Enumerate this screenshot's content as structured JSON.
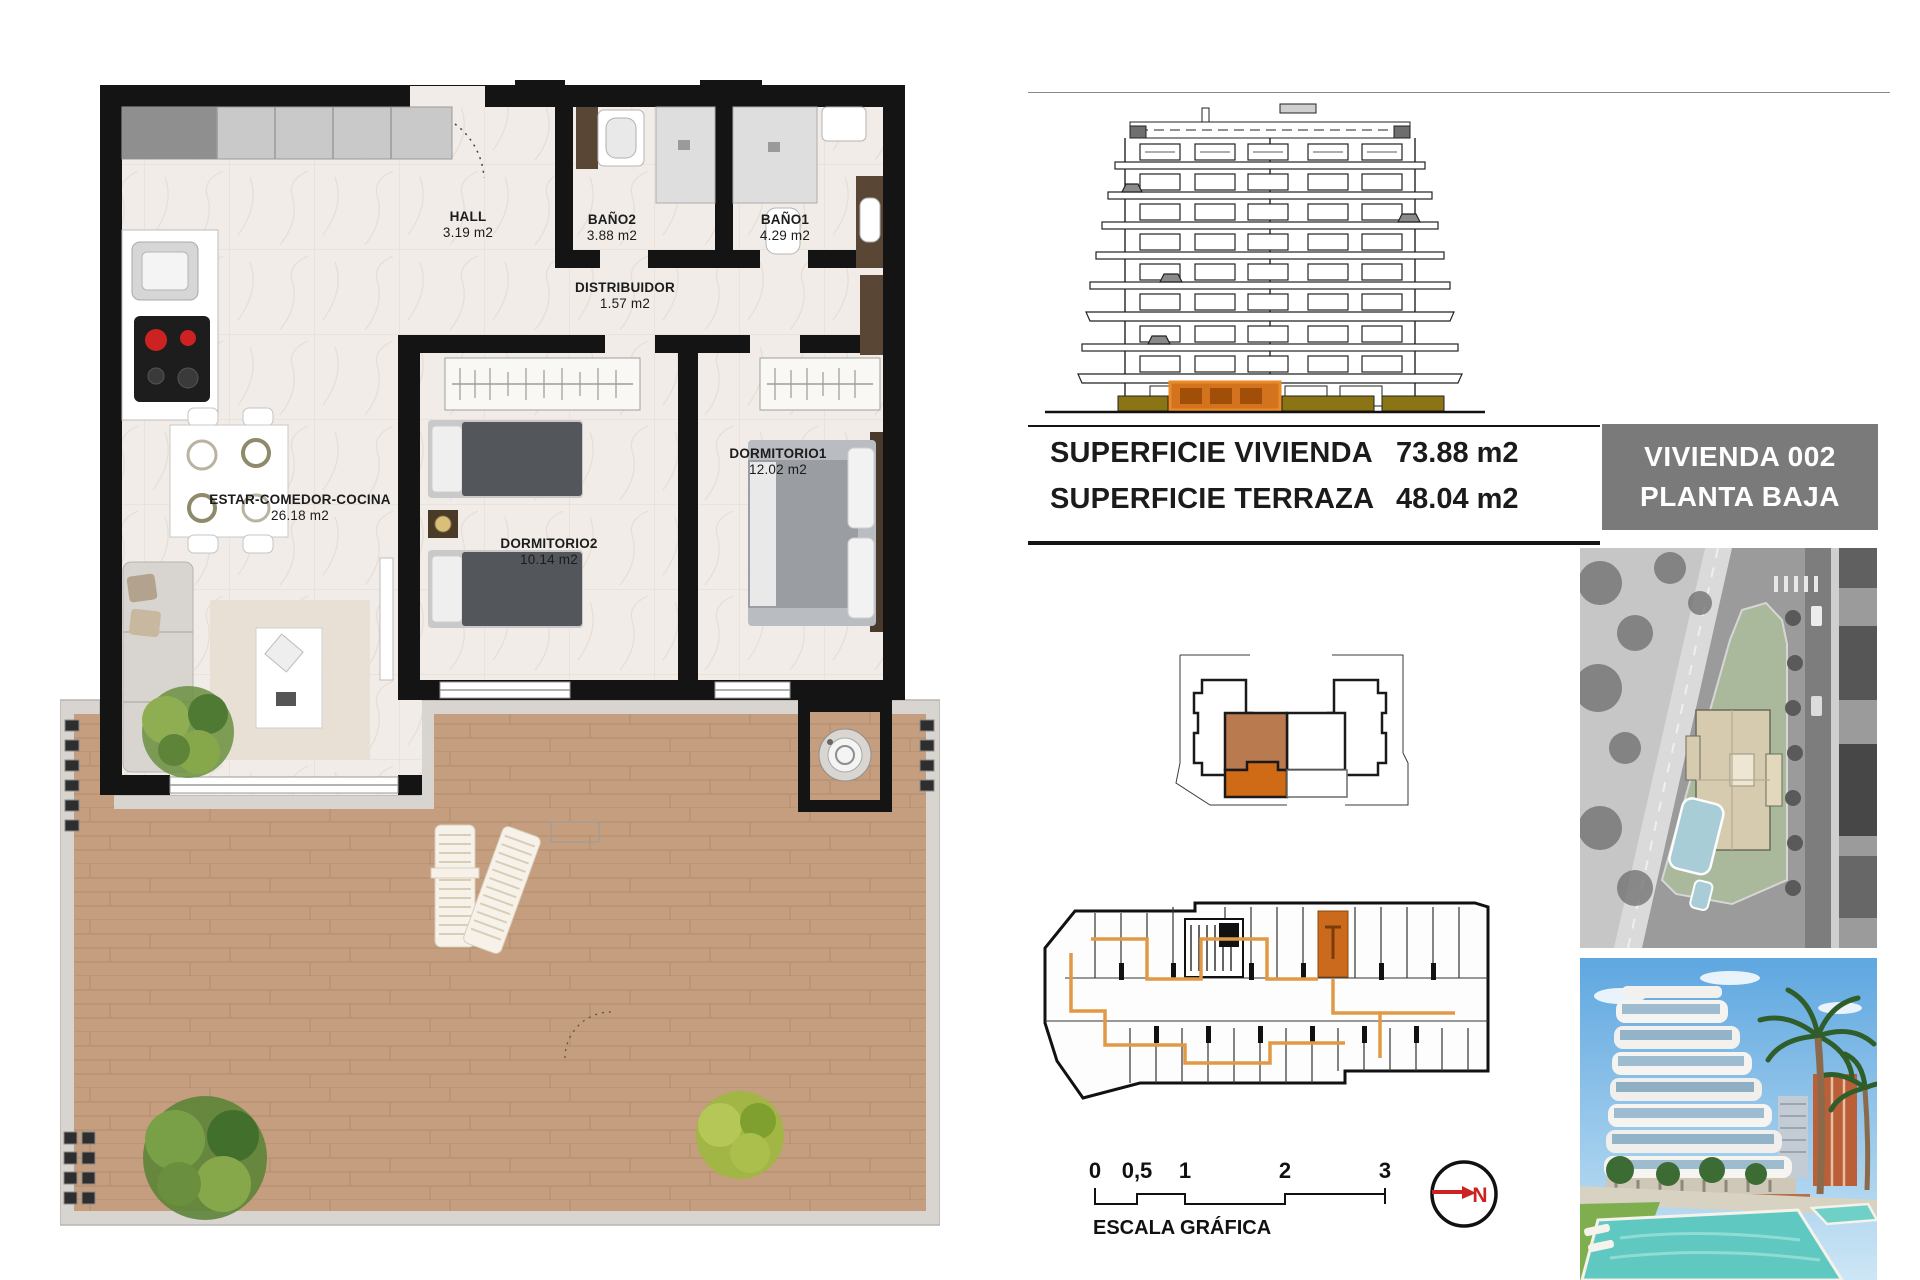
{
  "floor_plan": {
    "rooms": [
      {
        "id": "hall",
        "name": "HALL",
        "area": "3.19 m2"
      },
      {
        "id": "bano2",
        "name": "BAÑO2",
        "area": "3.88 m2"
      },
      {
        "id": "bano1",
        "name": "BAÑO1",
        "area": "4.29 m2"
      },
      {
        "id": "distribuidor",
        "name": "DISTRIBUIDOR",
        "area": "1.57 m2"
      },
      {
        "id": "dormitorio2",
        "name": "DORMITORIO2",
        "area": "10.14 m2"
      },
      {
        "id": "dormitorio1",
        "name": "DORMITORIO1",
        "area": "12.02 m2"
      },
      {
        "id": "estar",
        "name": "ESTAR-COMEDOR-COCINA",
        "area": "26.18 m2"
      }
    ]
  },
  "summary_table": {
    "rows": [
      {
        "label": "SUPERFICIE VIVIENDA",
        "value": "73.88 m2"
      },
      {
        "label": "SUPERFICIE TERRAZA",
        "value": "48.04 m2"
      }
    ]
  },
  "unit_badge": {
    "line1": "VIVIENDA 002",
    "line2": "PLANTA BAJA"
  },
  "scale_bar": {
    "ticks": [
      "0",
      "0,5",
      "1",
      "2",
      "3"
    ],
    "label": "ESCALA GRÁFICA"
  },
  "north_indicator": {
    "label": "N"
  },
  "colors": {
    "wall_black": "#141414",
    "deck_wood": "#c49e7e",
    "marble_floor": "#f1ece7",
    "highlight_orange": "#cf6a17",
    "key_orange_light": "#b97a50",
    "elevation_orange": "#d4731d",
    "planter_olive": "#8a7414",
    "badge_gray": "#7a7a7a",
    "north_red": "#cc2222",
    "pool_blue": "#62c8c4"
  }
}
